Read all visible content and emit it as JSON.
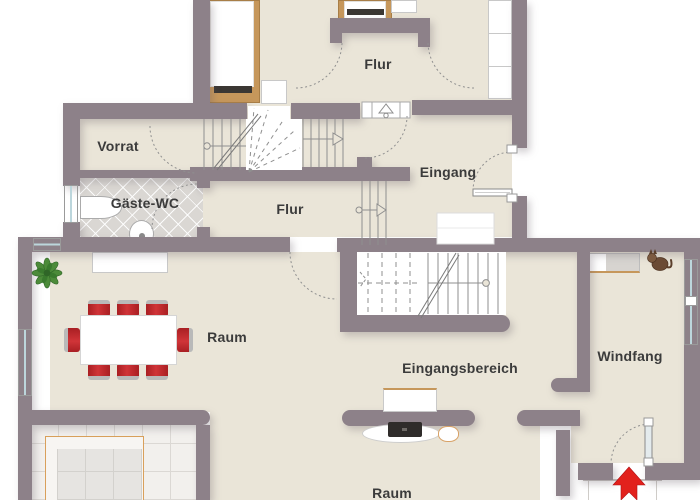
{
  "floorplan": {
    "rooms": {
      "vorrat": "Vorrat",
      "gaeste_wc": "Gäste-WC",
      "flur_upper": "Flur",
      "flur_lower": "Flur",
      "eingang": "Eingang",
      "raum_dining": "Raum",
      "eingangsbereich": "Eingangsbereich",
      "windfang": "Windfang",
      "raum_lower": "Raum"
    },
    "objects": [
      "bed",
      "bed",
      "nightstand",
      "nightstand",
      "wardrobe",
      "sink",
      "toilet",
      "dining-table",
      "chair-x8",
      "plant",
      "sideboard",
      "desk-with-laptop",
      "stool",
      "shoe-cabinet",
      "cat",
      "entrance-arrow",
      "stairs",
      "windows",
      "doors"
    ],
    "colors": {
      "wall": "#8D8189",
      "floor": "#EAE5D8",
      "wc_tile": "#DAD7D3",
      "room_tile": "#F2F0ED",
      "wood": "#C6975B",
      "chair_red": "#C0272D",
      "arrow_red": "#E2211C",
      "window_glass": "#BCD6DC",
      "line": "#8F8F8F",
      "text": "#3B3B3B"
    }
  }
}
